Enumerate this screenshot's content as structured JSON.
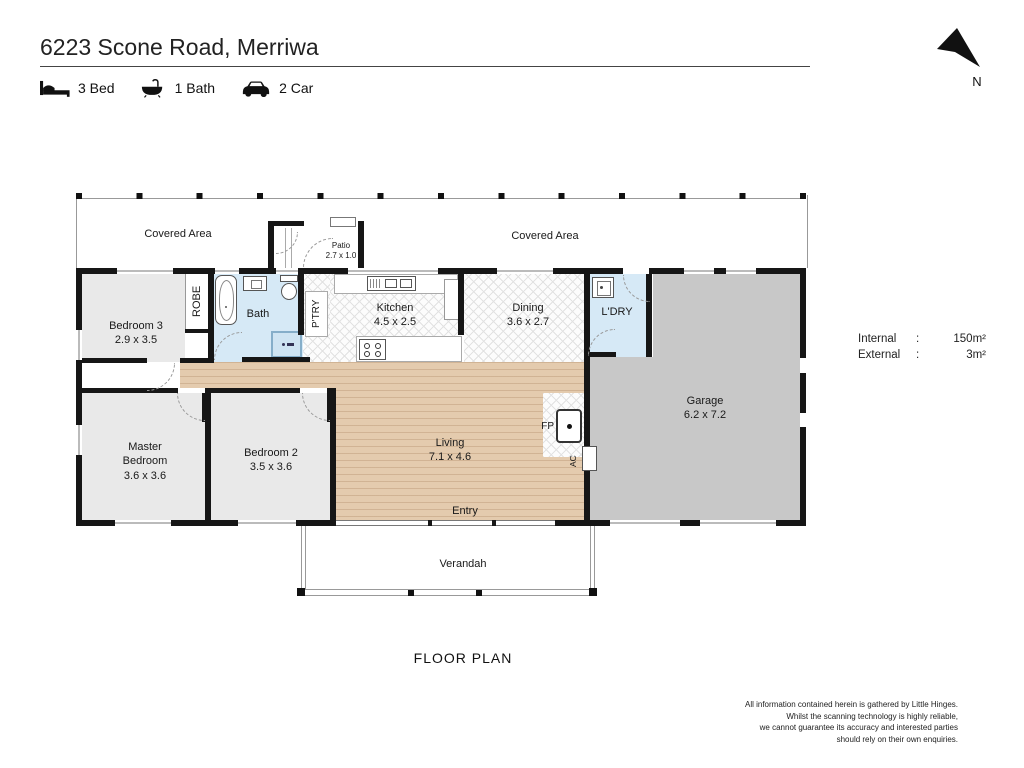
{
  "colors": {
    "wall": "#161616",
    "wood": "#e4cbae",
    "wet_blue": "#d6e9f6",
    "room_gray": "#e9e9e9",
    "garage_gray": "#c8c8c8"
  },
  "header": {
    "title": "6223 Scone Road, Merriwa",
    "features": [
      {
        "icon": "bed-icon",
        "label": "3 Bed"
      },
      {
        "icon": "bath-icon",
        "label": "1 Bath"
      },
      {
        "icon": "car-icon",
        "label": "2 Car"
      }
    ],
    "north_label": "N"
  },
  "areas": {
    "internal_label": "Internal",
    "internal_sep": ":",
    "internal_value": "150m²",
    "external_label": "External",
    "external_sep": ":",
    "external_value": "3m²"
  },
  "plan": {
    "covered_area_left": "Covered Area",
    "covered_area_right": "Covered Area",
    "patio_name": "Patio",
    "patio_dims": "2.7 x 1.0",
    "rooms": {
      "bedroom3": {
        "name": "Bedroom 3",
        "dims": "2.9 x 3.5"
      },
      "robe": {
        "name": "ROBE"
      },
      "bath": {
        "name": "Bath"
      },
      "pantry": {
        "name": "P'TRY"
      },
      "kitchen": {
        "name": "Kitchen",
        "dims": "4.5 x 2.5"
      },
      "dining": {
        "name": "Dining",
        "dims": "3.6 x 2.7"
      },
      "laundry": {
        "name": "L'DRY"
      },
      "garage": {
        "name": "Garage",
        "dims": "6.2 x 7.2"
      },
      "master": {
        "name": "Master Bedroom",
        "dims": "3.6 x 3.6"
      },
      "bedroom2": {
        "name": "Bedroom 2",
        "dims": "3.5 x 3.6"
      },
      "living": {
        "name": "Living",
        "dims": "7.1 x 4.6"
      },
      "entry": {
        "name": "Entry"
      },
      "verandah": {
        "name": "Verandah"
      },
      "fireplace": {
        "name": "FP"
      },
      "ac": {
        "name": "AC"
      }
    }
  },
  "footer": {
    "plan_label": "FLOOR PLAN",
    "disclaimer_lines": [
      "All information contained herein is gathered by Little Hinges.",
      "Whilst the scanning technology is highly reliable,",
      "we cannot guarantee its accuracy and interested parties",
      "should rely on their own enquiries."
    ]
  }
}
